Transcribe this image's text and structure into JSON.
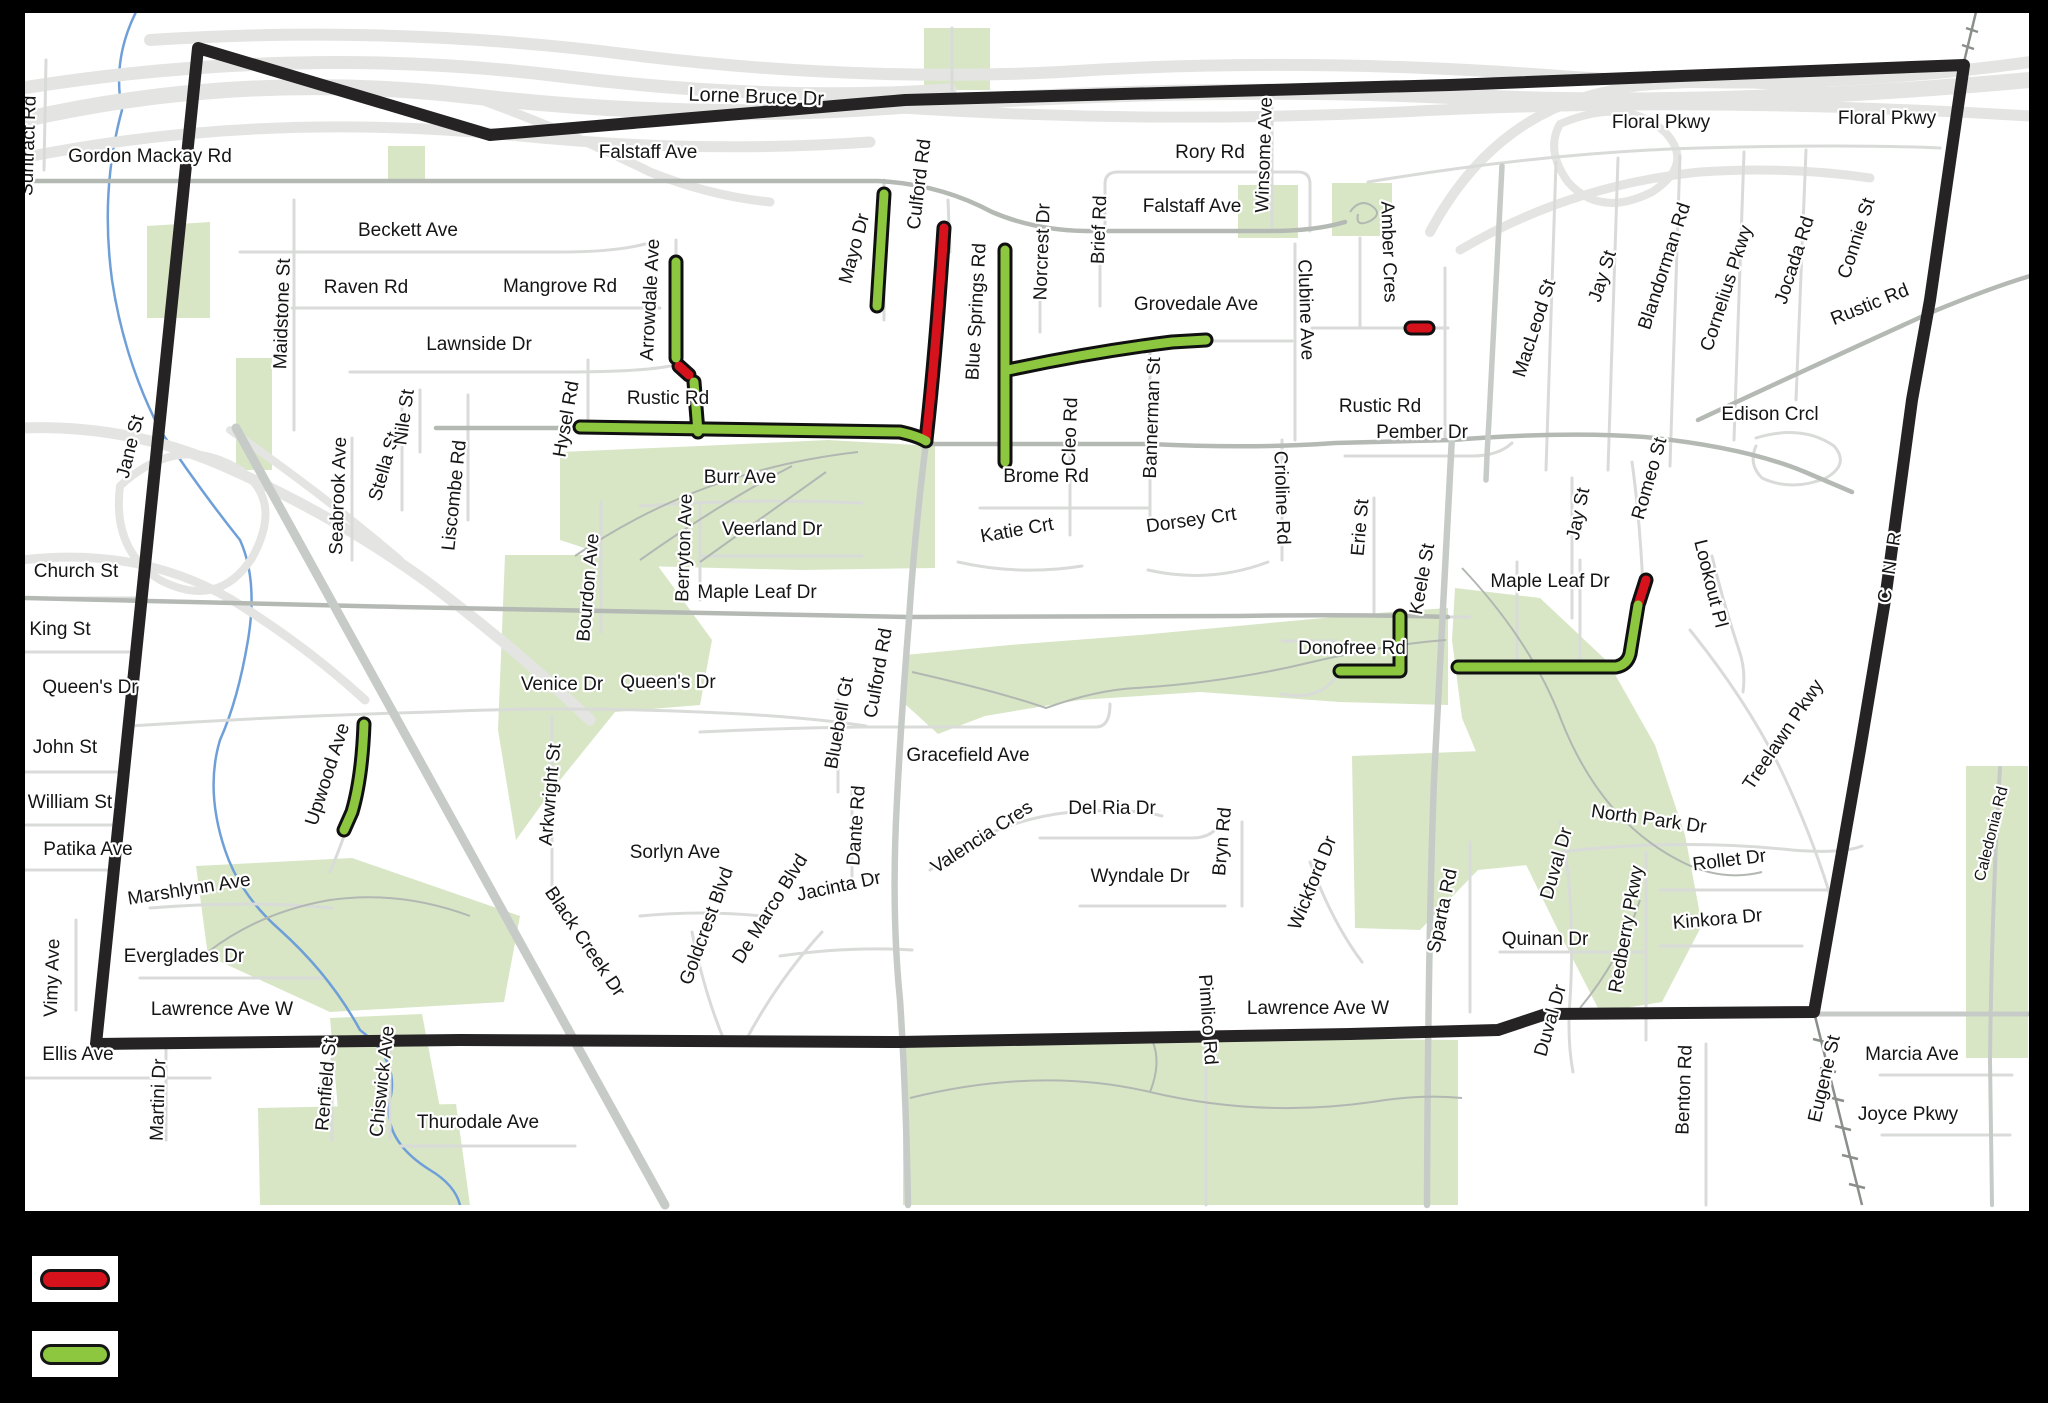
{
  "title": "road restriction map",
  "legend": {
    "items": [
      {
        "name": "red-segment-swatch",
        "color": "#d6121d",
        "box_y": 1256
      },
      {
        "name": "green-segment-swatch",
        "color": "#8dc63f",
        "box_y": 1331
      }
    ]
  },
  "colors": {
    "background": "#000000",
    "map_bg": "#ffffff",
    "frame": "#000000",
    "park": "#d8e6c6",
    "creek": "#6f9fd8",
    "highway": "#e4e5e3",
    "local_road": "#d9dbd9",
    "arterial_road": "#b4b9b4",
    "wide_road": "#c7cbc7",
    "trail": "#b2b7b2",
    "rail": "#8a8f8a",
    "boundary": "#262324",
    "closed_red": "#d6121d",
    "restricted_green": "#8dc63f",
    "casing": "#101010"
  },
  "map": {
    "frame": {
      "x": 22,
      "y": 10,
      "w": 2010,
      "h": 1204
    },
    "boundary": "M198,48 L490,135 L905,100 L1450,85 L1964,65 L1930,300 L1912,400 L1885,600 L1860,750 L1814,1012 L1546,1014 L1498,1030 L1350,1034 L900,1042 L460,1040 L96,1044 Z",
    "parks": [
      "M147,226 L210,222 L210,318 L147,318 Z",
      "M388,146 L425,146 L425,180 L388,180 Z",
      "M236,358 L272,358 L272,470 L236,470 Z",
      "M560,452 L700,446 L828,440 L935,446 L935,568 L800,570 L640,566 L560,540 Z",
      "M924,28 L990,28 L990,90 L924,90 Z",
      "M1238,185 L1298,185 L1298,238 L1238,238 Z",
      "M1332,183 L1392,183 L1392,236 L1332,236 Z",
      "M586,514 L614,514 L614,600 L586,600 Z",
      "M905,655 L1010,645 L1140,635 L1280,622 L1390,612 L1448,608 L1448,705 L1340,702 L1200,692 L1080,700 L985,716 L938,734 L905,704 Z",
      "M1455,588 L1540,598 L1608,662 L1655,745 L1685,835 L1702,925 L1662,1002 L1600,1012 L1558,930 L1508,828 L1462,718 L1452,640 Z",
      "M1352,756 L1560,748 L1600,800 L1558,862 L1478,870 L1420,930 L1355,928 Z",
      "M903,1046 L1240,1038 L1458,1040 L1458,1205 L903,1205 Z",
      "M196,866 L352,858 L520,916 L504,1002 L330,1012 L208,956 Z",
      "M258,1108 L456,1104 L470,1205 L260,1205 Z",
      "M330,1018 L422,1014 L440,1108 L338,1110 Z",
      "M1966,766 L2028,766 L2028,1058 L1966,1058 Z",
      "M505,555 L650,555 L712,640 L700,705 L615,712 L552,790 L516,840 L498,730 Z"
    ],
    "creeks": [
      "M136,12 Q112,60 122,110 Q100,190 112,280 Q124,360 160,430 Q200,490 240,540 Q258,580 248,640 Q238,700 220,740 Q205,790 225,850 Q240,895 280,930 Q330,975 360,1030 Q400,1060 390,1100 Q382,1140 430,1170 Q455,1185 460,1205"
    ],
    "highways": [
      {
        "d": "M22,120 Q240,70 470,96 Q700,122 900,106 Q1200,84 1450,96 Q1700,110 2030,80",
        "w": 16
      },
      {
        "d": "M22,88 Q300,44 560,76 Q770,102 950,90",
        "w": 13
      },
      {
        "d": "M150,40 Q400,24 640,56 Q860,82 1060,72 Q1300,56 1560,76 Q1800,94 2030,62",
        "w": 12
      },
      {
        "d": "M22,158 Q260,110 520,136 Q700,154 870,142",
        "w": 11
      },
      {
        "d": "M470,96 Q570,132 650,172 Q710,196 770,202",
        "w": 9
      },
      {
        "d": "M900,108 Q1150,124 1400,112 Q1700,96 2030,116",
        "w": 11
      },
      {
        "d": "M1430,232 Q1500,100 1640,86 Q1760,76 1850,96",
        "w": 10
      },
      {
        "d": "M1460,250 Q1570,185 1700,172 Q1790,166 1870,178",
        "w": 9
      },
      {
        "d": "M1560,124 Q1625,96 1665,132 Q1695,164 1652,192 Q1600,218 1568,182 Q1545,150 1560,124",
        "w": 8
      },
      {
        "d": "M22,428 Q130,424 228,468 Q340,518 430,584 Q520,652 590,720",
        "w": 11
      },
      {
        "d": "M22,560 Q140,546 232,600 Q305,645 365,700",
        "w": 9
      },
      {
        "d": "M120,486 Q178,432 240,470 Q284,500 252,558 Q218,610 160,580 Q112,550 120,486",
        "w": 8
      },
      {
        "d": "M230,430 Q320,492 400,560",
        "w": 8
      }
    ],
    "locals": [
      "M24,598 L143,598",
      "M24,652 L137,652",
      "M24,772 L124,772",
      "M24,825 L119,825",
      "M24,870 L114,870",
      "M24,1078 L210,1078",
      "M46,60 L44,170",
      "M240,252 H560 Q615,252 645,244",
      "M292,308 H660",
      "M350,372 H560 Q640,372 670,366",
      "M294,200 V430",
      "M676,240 V360 Q676,372 686,372",
      "M884,180 V320",
      "M948,200 L950,252",
      "M1105,231 V184 Q1105,172 1118,172 H1298 Q1310,172 1310,184 V231",
      "M1272,95 V231",
      "M1040,250 V332",
      "M1100,244 V306",
      "M1295,244 V440",
      "M1360,238 V328",
      "M1312,328 H1448",
      "M1445,268 V438",
      "M352,438 V560",
      "M402,395 V510",
      "M420,390 V452",
      "M468,395 V520",
      "M588,360 V428",
      "M640,506 Q760,498 862,503",
      "M700,506 V600",
      "M700,556 H862",
      "M601,502 V632",
      "M980,508 H1150",
      "M958,562 Q1020,576 1082,566",
      "M1148,570 Q1210,584 1268,562",
      "M1070,450 V535",
      "M1150,345 V530",
      "M1282,440 V560",
      "M1345,456 H1472 Q1498,456 1512,443",
      "M1374,498 V615",
      "M1572,478 V618",
      "M1632,462 Q1640,520 1643,588",
      "M1712,556 Q1723,602 1739,650 Q1746,670 1743,692",
      "M1756,438 Q1802,424 1834,446 Q1850,464 1826,478 Q1792,492 1762,478 Q1748,464 1756,446",
      "M1690,630 Q1748,702 1782,772 Q1812,836 1830,895",
      "M130,726 Q280,716 432,712 Q560,706 700,712 Q800,716 866,726",
      "M552,716 V900",
      "M364,714 Q360,780 344,836 Q336,858 330,872",
      "M700,732 Q780,728 862,727 H1096 Q1110,727 1110,704",
      "M852,786 V880",
      "M838,700 V792",
      "M1040,838 H1192 Q1214,838 1222,820",
      "M930,870 Q992,820 1072,812 Q1134,808 1162,816",
      "M1080,906 H1225",
      "M1242,822 V906",
      "M1310,862 Q1332,922 1362,962",
      "M780,956 Q850,946 912,950",
      "M640,916 Q702,910 762,916",
      "M692,932 Q704,992 724,1040",
      "M746,1040 Q778,980 822,932",
      "M150,908 Q250,900 332,908",
      "M140,978 H322",
      "M76,920 V1010",
      "M166,1044 V1140",
      "M332,1042 V1140",
      "M390,1040 V1138",
      "M400,1146 H575",
      "M1206,980 V1205",
      "M1560,822 Q1576,900 1570,1000 Q1567,1040 1573,1072",
      "M1500,952 H1642",
      "M1646,852 V1040",
      "M1660,946 H1802",
      "M1660,890 H1832",
      "M1560,852 Q1680,838 1792,850 Q1842,854 1862,846",
      "M1470,842 V1012",
      "M1706,1044 V1205",
      "M1880,1075 H2012",
      "M1882,1135 H2010",
      "M1368,182 Q1550,152 1700,148 Q1850,144 1940,148",
      "M1556,162 L1546,470",
      "M1618,158 L1608,470",
      "M1680,156 L1670,466",
      "M1744,152 L1734,440",
      "M1806,150 L1796,400",
      "M1205,341 H1292",
      "M1282,641 H1336",
      "M1281,694 Q1320,702 1338,674",
      "M1448,617 H1470",
      "M1517,562 V663",
      "M1580,560 V662",
      "M952,28 V90"
    ],
    "arterials": [
      "M24,181 H878 Q940,184 992,212 Q1034,230 1085,231 H1270 Q1315,231 1345,222",
      "M928,444 H1150 Q1255,449 1335,443 L1452,440",
      "M1452,440 Q1565,431 1645,437 Q1745,447 1805,472 L1852,492",
      "M24,598 Q200,602 400,607 Q700,614 908,617 L1240,616 Q1350,614 1448,617",
      "M1698,420 Q1822,362 1932,312 Q1990,288 2030,276",
      "M436,428 H578"
    ],
    "wides": [
      {
        "d": "M236,428 L665,1205",
        "w": 9
      },
      {
        "d": "M926,442 Q914,540 909,620 Q901,720 897,800 Q891,910 900,1000 Q906,1090 908,1205",
        "w": 6.5
      },
      {
        "d": "M1452,436 Q1442,620 1434,780 Q1428,940 1427,1205",
        "w": 6.5
      },
      {
        "d": "M1502,166 Q1496,280 1489,420 Q1487,450 1486,480",
        "w": 5.5
      },
      {
        "d": "M1814,1014 H2030",
        "w": 5
      },
      {
        "d": "M2000,768 Q1992,900 1990,1060 L1992,1205",
        "w": 4
      }
    ],
    "trails": [
      "M575,556 Q700,470 858,452",
      "M640,560 Q722,502 792,466",
      "M700,562 L826,472",
      "M912,672 Q1000,692 1046,708 Q1096,690 1136,688 Q1230,682 1312,662 Q1390,644 1446,640",
      "M910,1098 Q1040,1066 1150,1092 Q1260,1118 1372,1102 Q1420,1094 1462,1098",
      "M1150,1092 Q1162,1062 1152,1040",
      "M1462,568 Q1532,642 1562,722 Q1602,822 1682,862 Q1722,882 1762,872",
      "M1350,212 Q1360,198 1372,206 Q1383,214 1370,221 Q1355,228 1358,214",
      "M1580,1008 Q1620,960 1640,900",
      "M208,952 Q260,912 330,900 Q400,890 470,916"
    ],
    "rails": [
      "M1814,1012 L1862,1205",
      "M1813,1039 L1829,1043",
      "M1820,1068 L1836,1072",
      "M1828,1097 L1844,1101",
      "M1835,1126 L1851,1130",
      "M1842,1155 L1858,1159",
      "M1849,1184 L1865,1188",
      "M1964,62 L1976,12",
      "M1962,45 L1974,49",
      "M1966,28 L1978,32"
    ],
    "red_segments": [
      "M944,228 Q936,350 926,440",
      "M679,366 L689,375",
      "M1411,328 L1428,328",
      "M1639,602 L1646,580"
    ],
    "green_segments": [
      "M580,427 L900,432 Q918,436 926,441",
      "M884,194 L877,306",
      "M676,262 V358",
      "M694,382 L698,432",
      "M1005,250 V462",
      "M1008,370 Q1092,352 1172,342 L1206,340",
      "M364,724 Q362,778 352,812 L344,830",
      "M1340,671 H1400 L1400,616",
      "M1458,667 H1616 Q1627,665 1630,654 L1638,605"
    ],
    "labels": [
      {
        "t": "Suntract Rd",
        "x": 34,
        "y": 146,
        "r": -88
      },
      {
        "t": "Gordon Mackay Rd",
        "x": 150,
        "y": 162,
        "r": 0
      },
      {
        "t": "Falstaff Ave",
        "x": 648,
        "y": 158,
        "r": 0
      },
      {
        "t": "Lorne Bruce Dr",
        "x": 756,
        "y": 103,
        "r": 2,
        "s": 20
      },
      {
        "t": "Mayo Dr",
        "x": 860,
        "y": 250,
        "r": -75
      },
      {
        "t": "Culford Rd",
        "x": 925,
        "y": 185,
        "r": -83
      },
      {
        "t": "Rory Rd",
        "x": 1210,
        "y": 158,
        "r": 0
      },
      {
        "t": "Winsome Ave",
        "x": 1270,
        "y": 155,
        "r": -88
      },
      {
        "t": "Falstaff Ave",
        "x": 1192,
        "y": 212,
        "r": 0
      },
      {
        "t": "Brief Rd",
        "x": 1105,
        "y": 230,
        "r": -88
      },
      {
        "t": "Norcrest Dr",
        "x": 1048,
        "y": 252,
        "r": -88
      },
      {
        "t": "Amber Cres",
        "x": 1383,
        "y": 252,
        "r": 88
      },
      {
        "t": "Clubine Ave",
        "x": 1300,
        "y": 310,
        "r": 88
      },
      {
        "t": "Floral Pkwy",
        "x": 1661,
        "y": 128,
        "r": 0
      },
      {
        "t": "Floral Pkwy",
        "x": 1887,
        "y": 124,
        "r": 0
      },
      {
        "t": "Beckett Ave",
        "x": 408,
        "y": 236,
        "r": 0
      },
      {
        "t": "Maidstone St",
        "x": 288,
        "y": 314,
        "r": -88
      },
      {
        "t": "Raven Rd",
        "x": 366,
        "y": 293,
        "r": 0
      },
      {
        "t": "Mangrove Rd",
        "x": 560,
        "y": 292,
        "r": 0
      },
      {
        "t": "Arrowdale Ave",
        "x": 656,
        "y": 300,
        "r": -87
      },
      {
        "t": "Lawnside Dr",
        "x": 479,
        "y": 350,
        "r": 0
      },
      {
        "t": "Grovedale Ave",
        "x": 1196,
        "y": 310,
        "r": 0
      },
      {
        "t": "Blue Springs Rd",
        "x": 982,
        "y": 312,
        "r": -87
      },
      {
        "t": "MacLeod St",
        "x": 1540,
        "y": 330,
        "r": -72
      },
      {
        "t": "Jay St",
        "x": 1608,
        "y": 278,
        "r": -72
      },
      {
        "t": "Blandorman Rd",
        "x": 1670,
        "y": 268,
        "r": -72
      },
      {
        "t": "Cornelius Pkwy",
        "x": 1732,
        "y": 290,
        "r": -72
      },
      {
        "t": "Jocada Rd",
        "x": 1800,
        "y": 262,
        "r": -72
      },
      {
        "t": "Connie St",
        "x": 1862,
        "y": 240,
        "r": -72
      },
      {
        "t": "Rustic Rd",
        "x": 1872,
        "y": 310,
        "r": -22
      },
      {
        "t": "Rustic Rd",
        "x": 668,
        "y": 404,
        "r": 0
      },
      {
        "t": "Rustic Rd",
        "x": 1380,
        "y": 412,
        "r": 0
      },
      {
        "t": "Hysel Rd",
        "x": 572,
        "y": 420,
        "r": -80
      },
      {
        "t": "Bannerman St",
        "x": 1158,
        "y": 418,
        "r": -88
      },
      {
        "t": "Cleo Rd",
        "x": 1076,
        "y": 432,
        "r": -88
      },
      {
        "t": "Crioline Rd",
        "x": 1276,
        "y": 498,
        "r": 88
      },
      {
        "t": "Edison Crcl",
        "x": 1770,
        "y": 420,
        "r": 0
      },
      {
        "t": "Jane St",
        "x": 136,
        "y": 448,
        "r": -76
      },
      {
        "t": "Seabrook Ave",
        "x": 344,
        "y": 496,
        "r": -88
      },
      {
        "t": "Stella St",
        "x": 390,
        "y": 468,
        "r": -74
      },
      {
        "t": "Nile St",
        "x": 410,
        "y": 418,
        "r": -82
      },
      {
        "t": "Liscombe Rd",
        "x": 460,
        "y": 496,
        "r": -84
      },
      {
        "t": "Burr Ave",
        "x": 740,
        "y": 483,
        "r": 0
      },
      {
        "t": "Berryton Ave",
        "x": 690,
        "y": 548,
        "r": -88
      },
      {
        "t": "Veerland Dr",
        "x": 772,
        "y": 535,
        "r": 0
      },
      {
        "t": "Brome Rd",
        "x": 1046,
        "y": 482,
        "r": 0
      },
      {
        "t": "Katie Crt",
        "x": 1018,
        "y": 536,
        "r": -10
      },
      {
        "t": "Dorsey Crt",
        "x": 1192,
        "y": 526,
        "r": -8
      },
      {
        "t": "Pember Dr",
        "x": 1422,
        "y": 438,
        "r": 0
      },
      {
        "t": "Erie St",
        "x": 1366,
        "y": 528,
        "r": -85
      },
      {
        "t": "Keele St",
        "x": 1428,
        "y": 580,
        "r": -80
      },
      {
        "t": "Jay St",
        "x": 1584,
        "y": 515,
        "r": -78
      },
      {
        "t": "Romeo St",
        "x": 1655,
        "y": 480,
        "r": -74
      },
      {
        "t": "Lookout Pl",
        "x": 1705,
        "y": 585,
        "r": 76
      },
      {
        "t": "Maple Leaf Dr",
        "x": 757,
        "y": 598,
        "r": 0
      },
      {
        "t": "Maple Leaf Dr",
        "x": 1550,
        "y": 587,
        "r": 0
      },
      {
        "t": "Bourdon Ave",
        "x": 594,
        "y": 588,
        "r": -85
      },
      {
        "t": "C N R",
        "x": 1896,
        "y": 566,
        "r": -81,
        "ls": 5
      },
      {
        "t": "Church St",
        "x": 76,
        "y": 577,
        "r": 0
      },
      {
        "t": "King St",
        "x": 60,
        "y": 635,
        "r": 0
      },
      {
        "t": "Queen's Dr",
        "x": 90,
        "y": 693,
        "r": 0
      },
      {
        "t": "Donofree Rd",
        "x": 1352,
        "y": 654,
        "r": 0
      },
      {
        "t": "Treelawn Pkwy",
        "x": 1788,
        "y": 738,
        "r": -56
      },
      {
        "t": "Venice Dr",
        "x": 562,
        "y": 690,
        "r": 0
      },
      {
        "t": "Queen's Dr",
        "x": 668,
        "y": 688,
        "r": 0
      },
      {
        "t": "John St",
        "x": 65,
        "y": 753,
        "r": 0
      },
      {
        "t": "Bluebell Gt",
        "x": 845,
        "y": 724,
        "r": -80
      },
      {
        "t": "Culford Rd",
        "x": 884,
        "y": 674,
        "r": -80
      },
      {
        "t": "Gracefield Ave",
        "x": 968,
        "y": 761,
        "r": 0
      },
      {
        "t": "William St",
        "x": 70,
        "y": 808,
        "r": 0
      },
      {
        "t": "Upwood Ave",
        "x": 333,
        "y": 776,
        "r": -72
      },
      {
        "t": "Arkwright St",
        "x": 556,
        "y": 795,
        "r": -85
      },
      {
        "t": "Del Ria Dr",
        "x": 1112,
        "y": 814,
        "r": 0
      },
      {
        "t": "Valencia Cres",
        "x": 985,
        "y": 842,
        "r": -33
      },
      {
        "t": "North Park Dr",
        "x": 1648,
        "y": 825,
        "r": 8
      },
      {
        "t": "Patika Ave",
        "x": 88,
        "y": 855,
        "r": 0
      },
      {
        "t": "Dante Rd",
        "x": 862,
        "y": 826,
        "r": -86
      },
      {
        "t": "Bryn Rd",
        "x": 1228,
        "y": 842,
        "r": -85
      },
      {
        "t": "Wyndale Dr",
        "x": 1140,
        "y": 882,
        "r": 0
      },
      {
        "t": "Rollet Dr",
        "x": 1730,
        "y": 866,
        "r": -7
      },
      {
        "t": "Duval Dr",
        "x": 1562,
        "y": 865,
        "r": -74
      },
      {
        "t": "Redberry Pkwy",
        "x": 1632,
        "y": 930,
        "r": -80
      },
      {
        "t": "Kinkora Dr",
        "x": 1718,
        "y": 925,
        "r": -5
      },
      {
        "t": "Marshlynn Ave",
        "x": 190,
        "y": 895,
        "r": -9
      },
      {
        "t": "Wickford Dr",
        "x": 1318,
        "y": 885,
        "r": -68
      },
      {
        "t": "Sparta Rd",
        "x": 1448,
        "y": 912,
        "r": -78
      },
      {
        "t": "Quinan Dr",
        "x": 1545,
        "y": 945,
        "r": 0
      },
      {
        "t": "Sorlyn Ave",
        "x": 675,
        "y": 858,
        "r": 0
      },
      {
        "t": "Goldcrest Blvd",
        "x": 712,
        "y": 928,
        "r": -70
      },
      {
        "t": "De Marco Blvd",
        "x": 775,
        "y": 912,
        "r": -58
      },
      {
        "t": "Jacinta Dr",
        "x": 840,
        "y": 892,
        "r": -12
      },
      {
        "t": "Everglades Dr",
        "x": 184,
        "y": 962,
        "r": 0
      },
      {
        "t": "Black Creek Dr",
        "x": 580,
        "y": 945,
        "r": 56
      },
      {
        "t": "Vimy Ave",
        "x": 58,
        "y": 978,
        "r": -88
      },
      {
        "t": "Lawrence Ave W",
        "x": 222,
        "y": 1015,
        "r": 0
      },
      {
        "t": "Lawrence Ave W",
        "x": 1318,
        "y": 1014,
        "r": 0
      },
      {
        "t": "Pimlico Rd",
        "x": 1202,
        "y": 1020,
        "r": 86
      },
      {
        "t": "Duval Dr",
        "x": 1556,
        "y": 1022,
        "r": -74
      },
      {
        "t": "Ellis Ave",
        "x": 78,
        "y": 1060,
        "r": 0
      },
      {
        "t": "Martini Dr",
        "x": 164,
        "y": 1100,
        "r": -88
      },
      {
        "t": "Renfield St",
        "x": 332,
        "y": 1085,
        "r": -85
      },
      {
        "t": "Chiswick Ave",
        "x": 388,
        "y": 1082,
        "r": -84
      },
      {
        "t": "Thurodale Ave",
        "x": 478,
        "y": 1128,
        "r": 0
      },
      {
        "t": "Benton Rd",
        "x": 1690,
        "y": 1090,
        "r": -88
      },
      {
        "t": "Eugene St",
        "x": 1830,
        "y": 1080,
        "r": -77
      },
      {
        "t": "Marcia Ave",
        "x": 1912,
        "y": 1060,
        "r": 0
      },
      {
        "t": "Joyce Pkwy",
        "x": 1908,
        "y": 1120,
        "r": 0
      },
      {
        "t": "Caledonia Rd",
        "x": 1996,
        "y": 835,
        "r": -76,
        "s": 16
      }
    ]
  }
}
